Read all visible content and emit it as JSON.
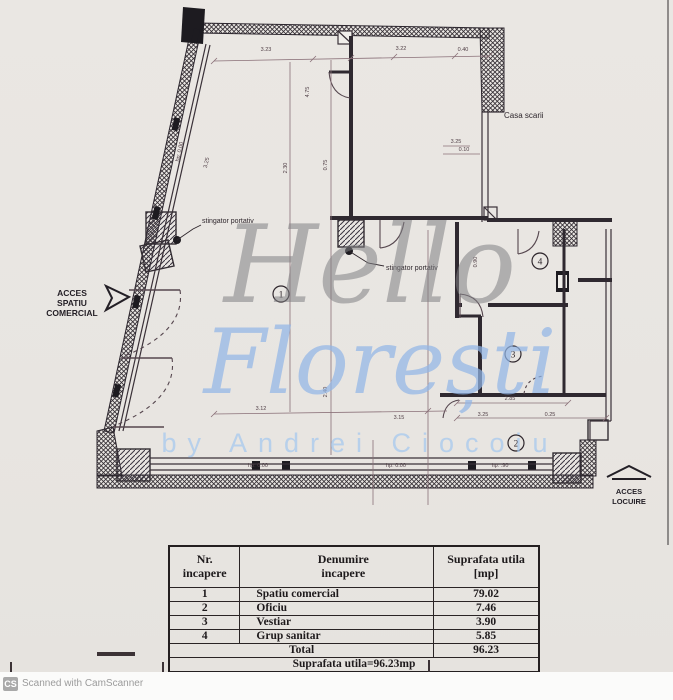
{
  "scanner": {
    "badge": "CS",
    "credit": "Scanned with CamScanner"
  },
  "watermark": {
    "line1": "Hello",
    "line2": "Florești",
    "byline": "by Andrei Ciocoiu"
  },
  "plan": {
    "labels": {
      "casa_scarii": "Casa scarii",
      "stingator_left": "stingator portativ",
      "stingator_right": "stingator portativ",
      "acces_spatiu_1": "ACCES",
      "acces_spatiu_2": "SPATIU",
      "acces_spatiu_3": "COMERCIAL",
      "acces_locuire_1": "ACCES",
      "acces_locuire_2": "LOCUIRE"
    },
    "rooms": {
      "r1": "1",
      "r2": "2",
      "r3": "3",
      "r4": "4"
    },
    "dims": {
      "top_a": "3.23",
      "top_b": "3.22",
      "top_c": "0.40",
      "v_a": "4.75",
      "v_b": "0.75",
      "v_c": "2.30",
      "v_d": "2.40",
      "v_e": "0.90",
      "right_a": "3.25",
      "right_b": "0.10",
      "low_a": "3.12",
      "low_b": "3.15",
      "low_c": "2.85",
      "low_d": "3.25",
      "low_e": "0.25",
      "hp_a": "hp: 0.00",
      "hp_b": "hp: 0.00",
      "hp_c": "hp: .90",
      "hp_wall": "hp: 0.00",
      "wall_dim": "3.25"
    }
  },
  "table": {
    "headers": {
      "col1a": "Nr.",
      "col1b": "incapere",
      "col2a": "Denumire",
      "col2b": "incapere",
      "col3a": "Suprafata utila",
      "col3b": "[mp]"
    },
    "rows": [
      {
        "nr": "1",
        "name": "Spatiu comercial",
        "area": "79.02"
      },
      {
        "nr": "2",
        "name": "Oficiu",
        "area": "7.46"
      },
      {
        "nr": "3",
        "name": "Vestiar",
        "area": "3.90"
      },
      {
        "nr": "4",
        "name": "Grup sanitar",
        "area": "5.85"
      }
    ],
    "total_label": "Total",
    "total_value": "96.23",
    "footer": "Suprafata utila=96.23mp"
  }
}
